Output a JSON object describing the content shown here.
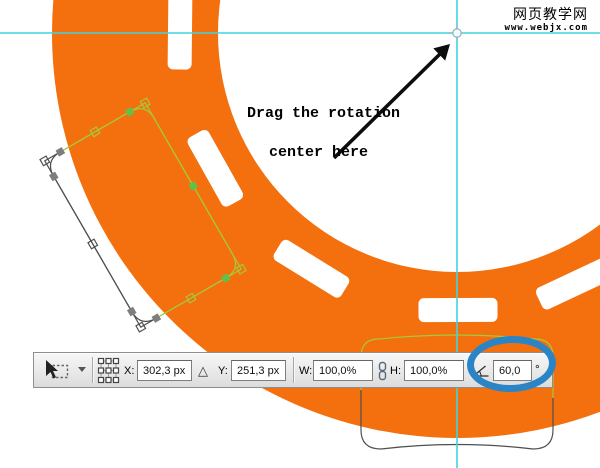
{
  "watermark": {
    "site_name": "网页教学网",
    "site_url": "www.webjx.com"
  },
  "annotation": {
    "line1": "Drag the rotation",
    "line2": "center here"
  },
  "toolbar": {
    "x_label": "X:",
    "x_value": "302,3 px",
    "y_label": "Y:",
    "y_value": "251,3 px",
    "w_label": "W:",
    "w_value": "100,0%",
    "h_label": "H:",
    "h_value": "100,0%",
    "angle_value": "60,0",
    "degree_symbol": "°",
    "delta_glyph": "△"
  },
  "colors": {
    "road_orange": "#f4700e",
    "guide_cyan": "#3fd4df",
    "path_green": "#a5c93b",
    "anchor_green": "#5fc14a",
    "path_gray": "#4f4f4f",
    "highlight_blue": "#2a84c5"
  }
}
